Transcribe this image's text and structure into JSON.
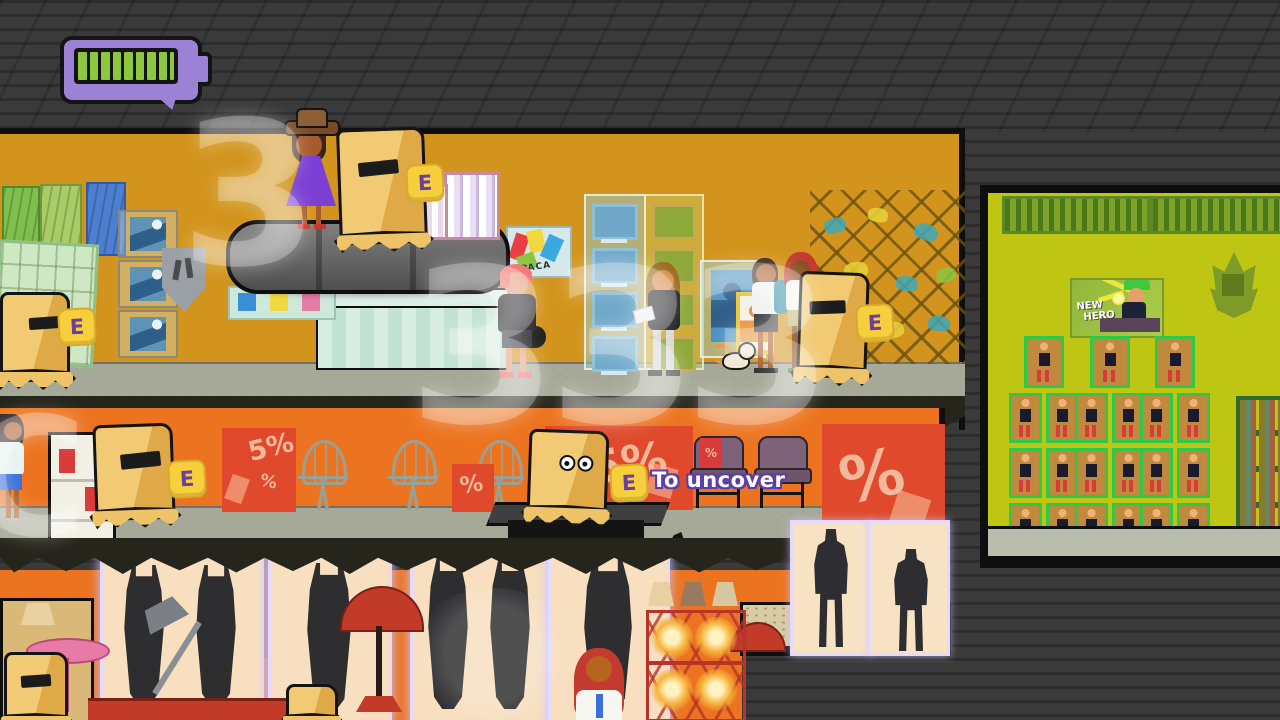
{
  "hud": {
    "battery": {
      "bars_filled": 8,
      "bars_total": 9,
      "fill_color": "#8DC63F",
      "frame_color": "#9C82D4",
      "style": "speech-bubble"
    }
  },
  "prompts": {
    "interact_key": "E",
    "uncover": {
      "key": "E",
      "label": "To uncover"
    }
  },
  "overlay": {
    "digit_top": "3",
    "digit_mid_left": "3",
    "digit_mid_right": "33",
    "letter_left": "C"
  },
  "posters": {
    "apaca": "APACA",
    "new_hero_line1": "NEW",
    "new_hero_line2": "HERO",
    "percent": "%",
    "five_percent": "5%"
  },
  "palette": {
    "background": "#3A3A3A",
    "level1_wall": "#D2941C",
    "level2_wall": "#EC7420",
    "store_wall": "#BFC513",
    "floor": "#A6A998",
    "slab": "#26251C",
    "bag": "#ECBE63",
    "key_bg": "#F7CE3C",
    "key_text": "#6B3FA0",
    "sale_red": "#E0492B",
    "battery_green": "#8DC63F",
    "battery_purple": "#9C82D4"
  }
}
